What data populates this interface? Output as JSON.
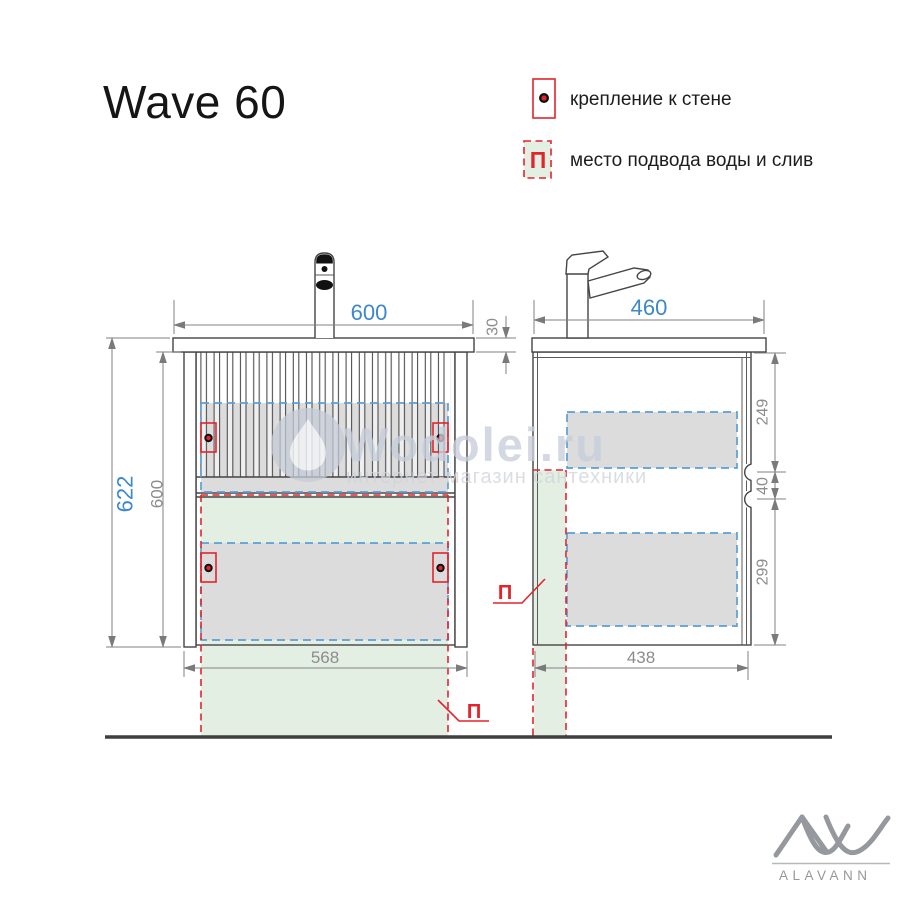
{
  "title": "Wave 60",
  "legend": {
    "wall_mount_label": "крепление к стене",
    "water_supply_label": "место подвода воды и слив",
    "water_symbol": "П"
  },
  "front_view": {
    "zone_label": "П",
    "dims": {
      "width_top": "600",
      "countertop_thickness": "30",
      "height_total": "622",
      "height_body": "600",
      "width_bottom": "568"
    }
  },
  "side_view": {
    "zone_label": "П",
    "dims": {
      "depth_top": "460",
      "upper_drawer": "249",
      "gap": "40",
      "lower_drawer": "299",
      "depth_bottom": "438"
    }
  },
  "watermark": {
    "site": "Wodolei.ru",
    "subtitle": "интернет-магазин сантехники"
  },
  "brand": {
    "name": "ALAVANN"
  },
  "colors": {
    "accent_red": "#e3242b",
    "dashed_blue": "#5b9fd8",
    "dimension_blue": "#3d87cc",
    "zone_green": "#e4efe4",
    "zone_gray": "#dcdcdc",
    "watermark_gray": "#c7cedb",
    "brand_gray": "#95989c"
  }
}
